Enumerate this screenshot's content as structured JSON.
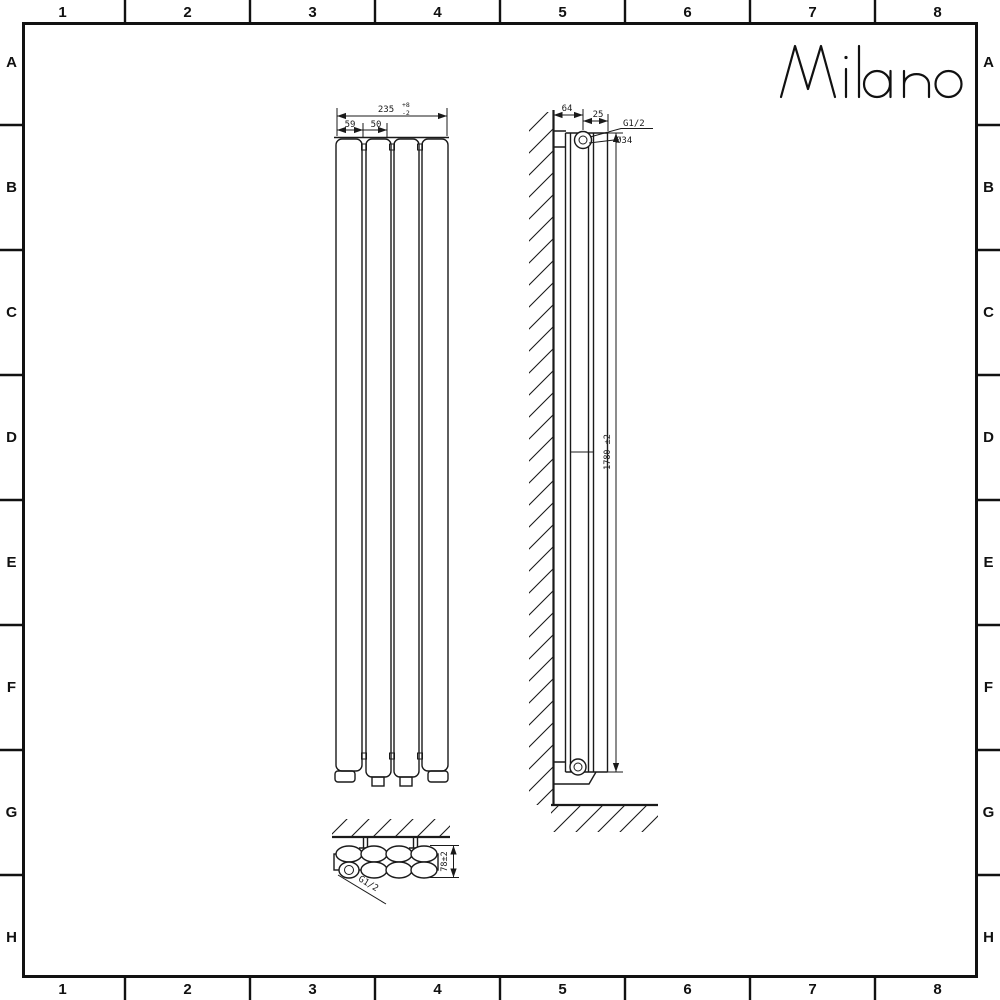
{
  "frame": {
    "columns": [
      "1",
      "2",
      "3",
      "4",
      "5",
      "6",
      "7",
      "8"
    ],
    "rows": [
      "A",
      "B",
      "C",
      "D",
      "E",
      "F",
      "G",
      "H"
    ]
  },
  "logo": {
    "text": "Milano"
  },
  "front_view": {
    "width_total": "235",
    "width_tol_plus": "+8",
    "width_tol_minus": "-2",
    "panel_dim_a": "59",
    "panel_dim_b": "50"
  },
  "side_view": {
    "wall_offset": "64",
    "top_offset": "25",
    "thread_label": "G1/2",
    "diameter_label": "Ø34",
    "height": "1780 ±2"
  },
  "top_view": {
    "depth": "78±2",
    "thread_label": "G1/2"
  },
  "colors": {
    "line": "#1a1a1a",
    "background": "#ffffff"
  }
}
